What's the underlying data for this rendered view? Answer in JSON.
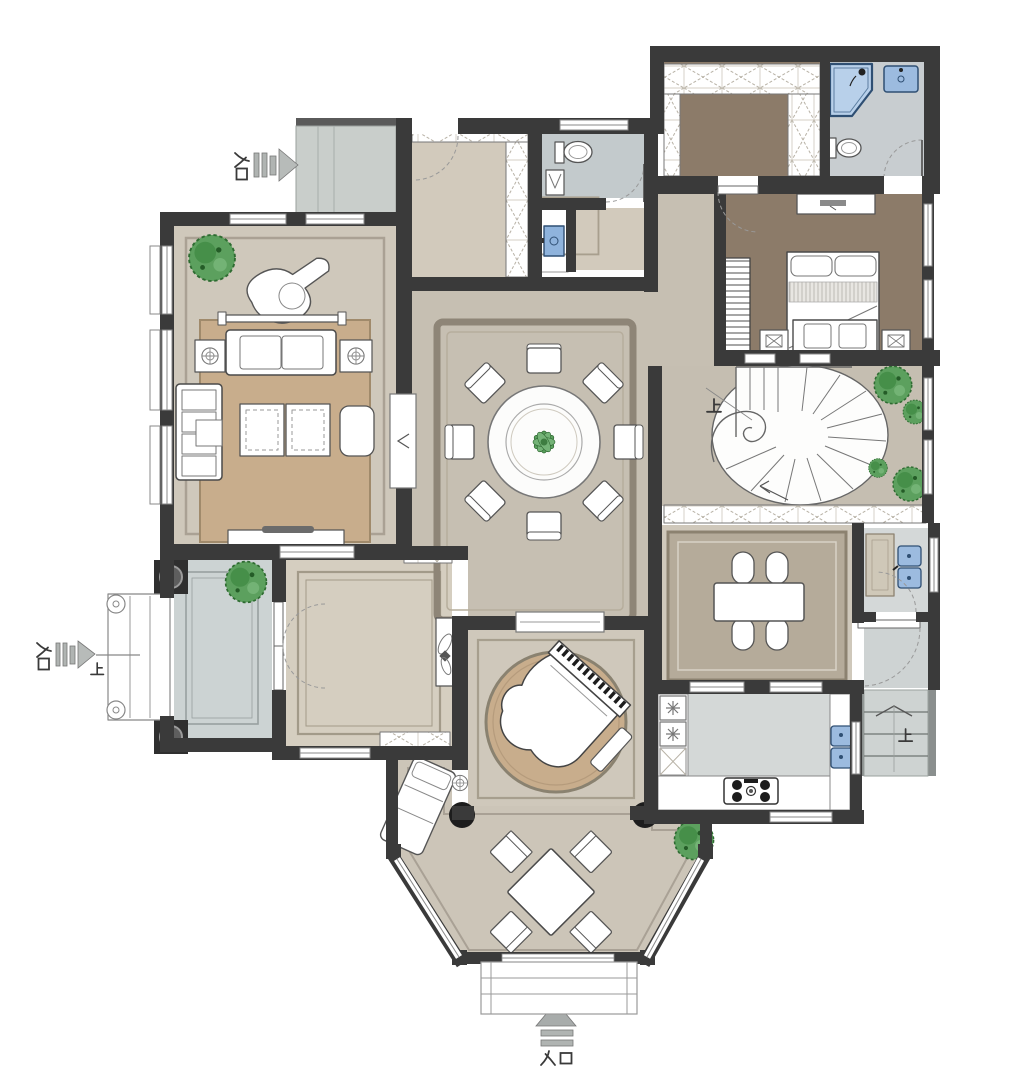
{
  "plan": {
    "entrances": [
      {
        "id": "top-left",
        "label": "入口",
        "direction": "right"
      },
      {
        "id": "left-side",
        "label": "入口",
        "direction": "right",
        "steps_label": "上"
      },
      {
        "id": "front",
        "label": "入口",
        "direction": "up"
      }
    ],
    "level_markers": [
      {
        "at": "spiral-staircase",
        "label": "上"
      },
      {
        "at": "porch-steps",
        "label": "上"
      },
      {
        "at": "rear-steps",
        "label": "上"
      }
    ],
    "counts": {
      "round_dining_chairs": 8,
      "family_table_chairs": 4,
      "sunroom_chairs": 4,
      "sofas": 2,
      "beds": 1
    }
  },
  "colors": {
    "wall": "#3a3a3a",
    "floor_main": "#cfc8bb",
    "floor_hall": "#c6bfb2",
    "floor_study": "#d5cec0",
    "floor_bedroom_brown": "#8c7b69",
    "floor_porch_gray": "#ccd3d3",
    "floor_bath_gray": "#c8cdd0",
    "floor_kitchen_gray": "#d4d8d7",
    "terrace_gray": "#c9cecb",
    "rug_tan": "#c8ad8c",
    "rug_family": "#b5ab9a",
    "ceiling_band": "#8e8577",
    "fixture_blue": "#9cbbdf",
    "fixture_blue_dark": "#2f4f73",
    "plant_green": "#5ca05e",
    "furniture_white": "#ffffff",
    "arrow_gray": "#b7bbb9"
  }
}
